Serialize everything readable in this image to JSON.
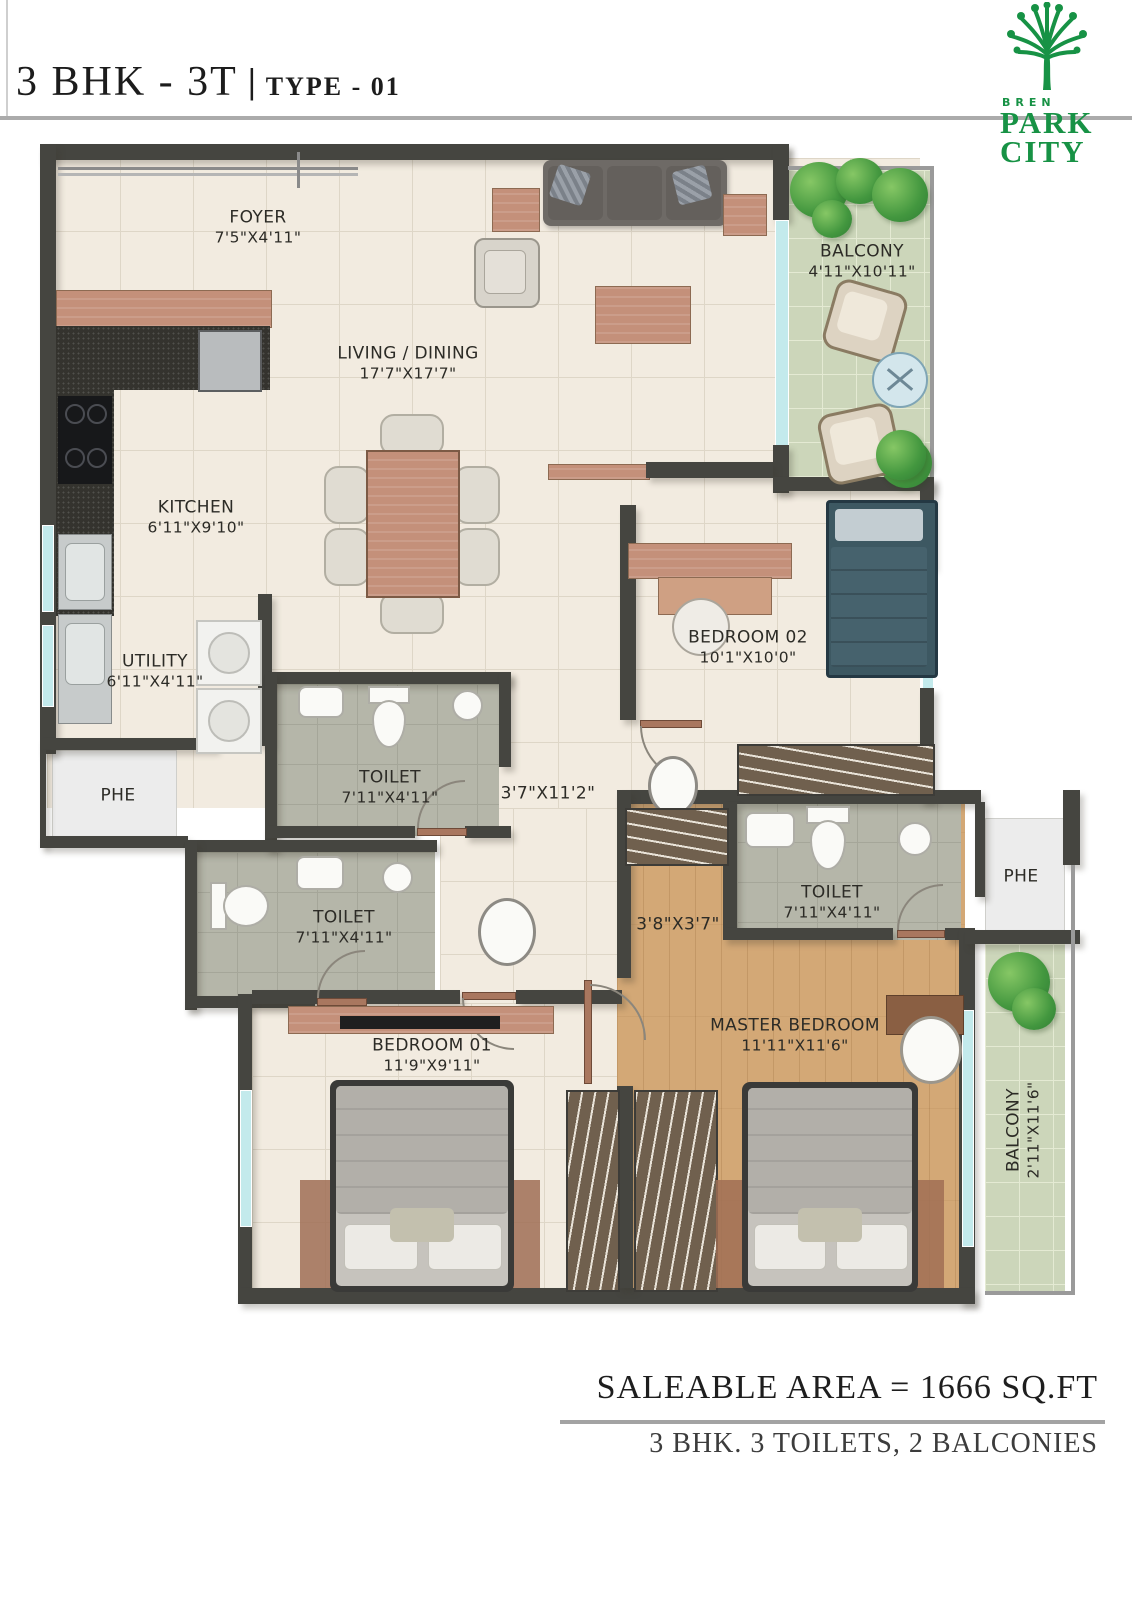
{
  "header": {
    "title": "3 BHK - 3T",
    "separator": "|",
    "subtitle": "TYPE - 01"
  },
  "logo": {
    "brand": "BREN",
    "line1": "PARK",
    "line2": "CITY"
  },
  "rooms": {
    "foyer": {
      "label": "FOYER",
      "dims": "7'5\"X4'11\""
    },
    "living": {
      "label": "LIVING / DINING",
      "dims": "17'7\"X17'7\""
    },
    "balcony1": {
      "label": "BALCONY",
      "dims": "4'11\"X10'11\""
    },
    "kitchen": {
      "label": "KITCHEN",
      "dims": "6'11\"X9'10\""
    },
    "utility": {
      "label": "UTILITY",
      "dims": "6'11\"X4'11\""
    },
    "phe_left": {
      "label": "PHE"
    },
    "toilet1": {
      "label": "TOILET",
      "dims": "7'11\"X4'11\""
    },
    "corridor": {
      "dims": "3'7\"X11'2\""
    },
    "bedroom02": {
      "label": "BEDROOM 02",
      "dims": "10'1\"X10'0\""
    },
    "toilet2": {
      "label": "TOILET",
      "dims": "7'11\"X4'11\""
    },
    "passage": {
      "dims": "3'8\"X3'7\""
    },
    "toilet3": {
      "label": "TOILET",
      "dims": "7'11\"X4'11\""
    },
    "phe_right": {
      "label": "PHE"
    },
    "bedroom01": {
      "label": "BEDROOM 01",
      "dims": "11'9\"X9'11\""
    },
    "master": {
      "label": "MASTER BEDROOM",
      "dims": "11'11\"X11'6\""
    },
    "balcony2": {
      "label": "BALCONY",
      "dims": "2'11\"X11'6\""
    }
  },
  "footer": {
    "area_line": "SALEABLE AREA = 1666 SQ.FT",
    "config_line": "3 BHK. 3 TOILETS, 2 BALCONIES"
  },
  "colors": {
    "wall": "#454540",
    "floor": "#f2ebe0",
    "floor_line": "#ded6c7",
    "wood_floor": "#d3a876",
    "balcony_tile": "#ccd6ba",
    "balcony_line": "#e4ead3",
    "toilet_tile": "#b5b6a9",
    "toilet_line": "#a5a699",
    "phe_floor": "#ececec",
    "wood_furn": "#c4907a",
    "counter_dark": "#34332e",
    "sofa": "#6e6a66",
    "chair_light": "#e0dcd2",
    "bed_frame": "#3a3a38",
    "bed_gray": "#c6c3bd",
    "bed_teal": "#3d5862",
    "pillow": "#eceae5",
    "wardrobe": "#70604e",
    "glass": "#c3eaec",
    "fixture": "#fafaf7",
    "fixture_border": "#aeada6",
    "rail_gray": "#9a9a9a",
    "rug_brown": "#a06f55",
    "logo_green": "#179245"
  }
}
